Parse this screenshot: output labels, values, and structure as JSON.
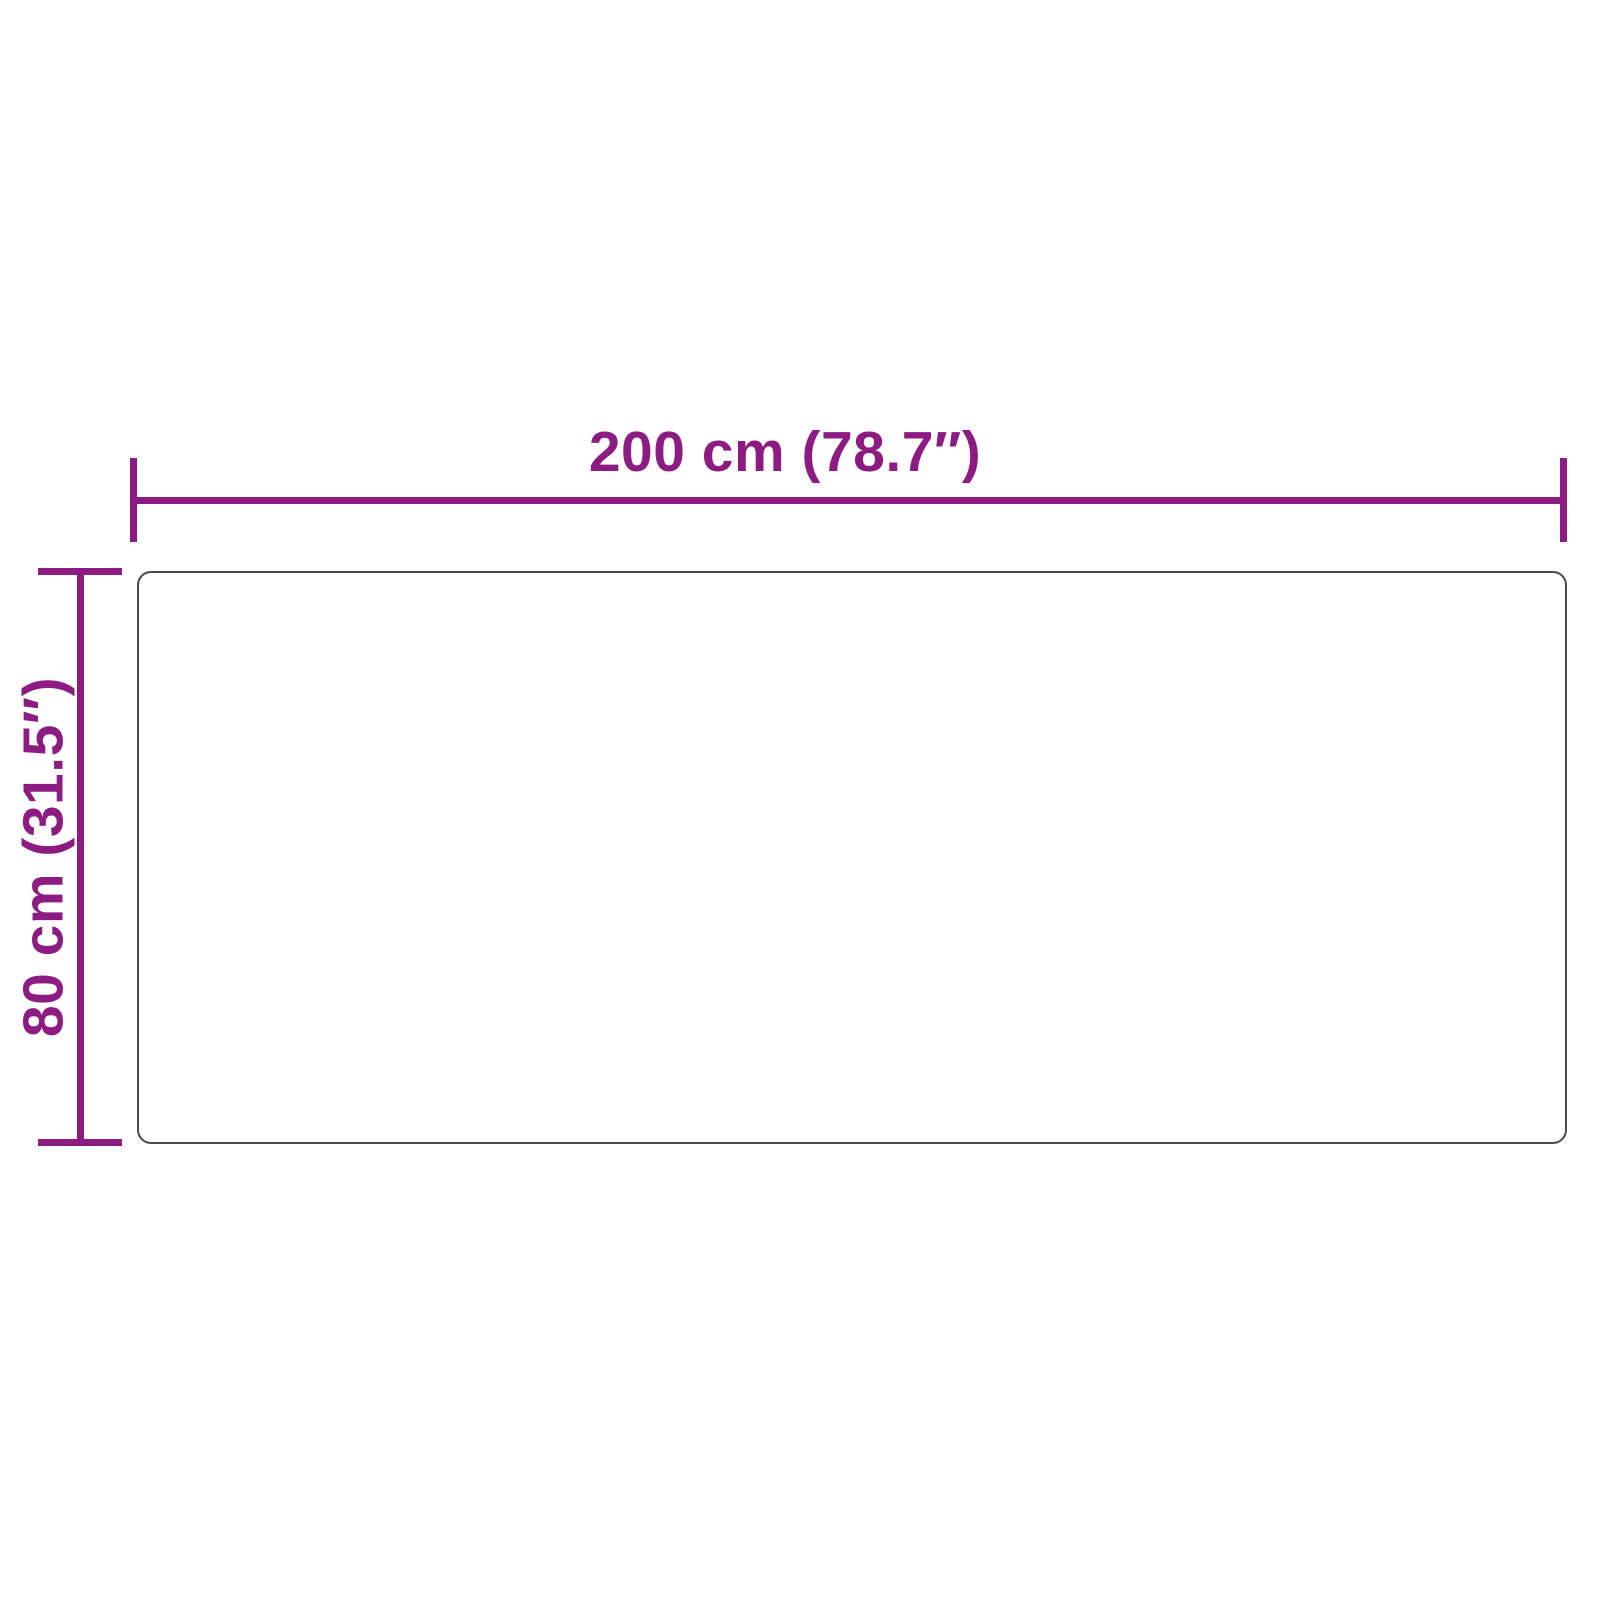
{
  "theme": {
    "dimension_color": "#8C1B82",
    "object_border_color": "#4B4B4B",
    "background_color": "#FFFFFF"
  },
  "diagram": {
    "type": "product-dimension-diagram",
    "object": "rectangular-panel",
    "dimensions": {
      "width": {
        "label": "200 cm (78.7″)",
        "value_cm": 200,
        "value_in": 78.7
      },
      "height": {
        "label": "80 cm (31.5″)",
        "value_cm": 80,
        "value_in": 31.5
      }
    }
  }
}
